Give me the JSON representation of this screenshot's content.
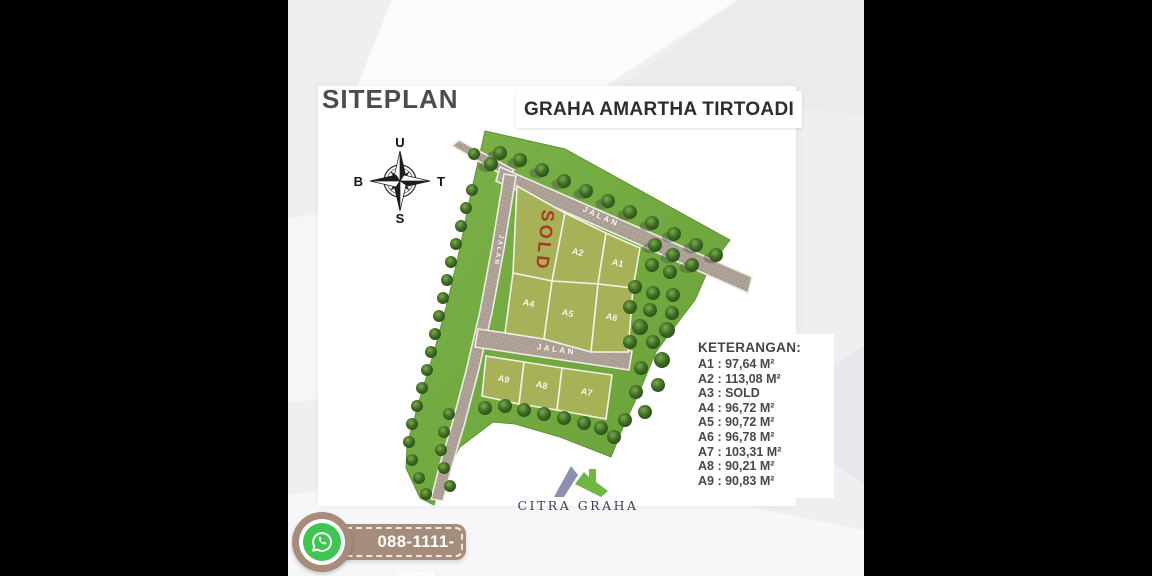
{
  "header": {
    "siteplan_label": "SITEPLAN",
    "project_title": "GRAHA AMARTHA TIRTOADI"
  },
  "compass": {
    "north_label": "U",
    "east_label": "T",
    "south_label": "S",
    "west_label": "B"
  },
  "map": {
    "road_label": "JALAN",
    "sold_label": "SOLD",
    "plots": [
      {
        "id": "A1",
        "label": "A1"
      },
      {
        "id": "A2",
        "label": "A2"
      },
      {
        "id": "A3",
        "label": "SOLD",
        "sold": true
      },
      {
        "id": "A4",
        "label": "A4"
      },
      {
        "id": "A5",
        "label": "A5"
      },
      {
        "id": "A6",
        "label": "A6"
      },
      {
        "id": "A7",
        "label": "A7"
      },
      {
        "id": "A8",
        "label": "A8"
      },
      {
        "id": "A9",
        "label": "A9"
      }
    ]
  },
  "legend": {
    "title": "KETERANGAN:",
    "items": [
      "A1 : 97,64 M²",
      "A2 : 113,08 M²",
      "A3 : SOLD",
      "A4 : 96,72 M²",
      "A5 : 90,72 M²",
      "A6 : 96,78 M²",
      "A7 : 103,31 M²",
      "A8 : 90,21 M²",
      "A9 : 90,83 M²"
    ]
  },
  "branding": {
    "logo_text": "CITRA GRAHA"
  },
  "contact": {
    "whatsapp_number": "088-1111-2020"
  },
  "colors": {
    "grass_green": "#71a73f",
    "plot_green": "#a7b258",
    "road_gray": "#b3a69d",
    "sold_red": "#a93a26",
    "badge_brown": "#a68d7b",
    "whatsapp_green": "#3fc552",
    "logo_purple": "#8d8fae",
    "logo_green": "#6fb643"
  }
}
